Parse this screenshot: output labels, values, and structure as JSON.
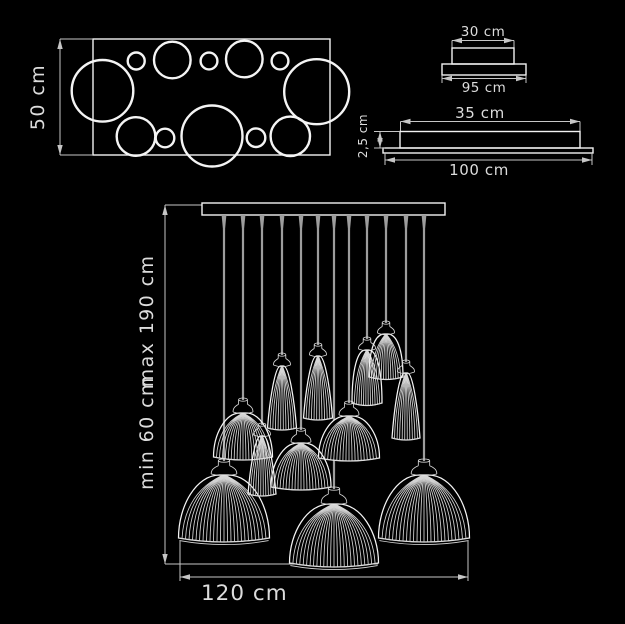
{
  "title": "pendant chandelier dimension drawing",
  "colors": {
    "background": "#000000",
    "line": "#f2f2f2",
    "dim_line": "#c6c6c6",
    "wire": "#9d9d9d",
    "text": "#dcdcdc"
  },
  "views": {
    "top_view": {
      "label": "50 cm",
      "rect": {
        "x": 93,
        "y": 39,
        "w": 237,
        "h": 116
      },
      "circles": [
        {
          "cx": 102.5,
          "cy": 90.8,
          "r": 30.8
        },
        {
          "cx": 136.2,
          "cy": 61,
          "r": 8.5
        },
        {
          "cx": 172.3,
          "cy": 60,
          "r": 18.3
        },
        {
          "cx": 209,
          "cy": 61,
          "r": 8.4
        },
        {
          "cx": 244.3,
          "cy": 59,
          "r": 18.3
        },
        {
          "cx": 280,
          "cy": 61,
          "r": 8.4
        },
        {
          "cx": 316.7,
          "cy": 91.7,
          "r": 32.5
        },
        {
          "cx": 136,
          "cy": 136.5,
          "r": 19.3
        },
        {
          "cx": 165,
          "cy": 138,
          "r": 9.3
        },
        {
          "cx": 212,
          "cy": 136,
          "r": 30.5
        },
        {
          "cx": 256,
          "cy": 137.7,
          "r": 9.3
        },
        {
          "cx": 290.3,
          "cy": 136.3,
          "r": 19.7
        }
      ],
      "dim": {
        "x": 60,
        "y1": 39,
        "y2": 155
      }
    },
    "side_view_small": {
      "top_label": "30 cm",
      "bottom_label": "95 cm",
      "box": {
        "x": 452,
        "y": 48,
        "w": 62,
        "h": 16
      },
      "base": {
        "x": 442,
        "y": 64,
        "w": 84,
        "h": 11
      },
      "top_dim": {
        "y": 40.5,
        "x1": 452,
        "x2": 514
      },
      "bottom_dim": {
        "y": 78.5,
        "x1": 442,
        "x2": 526,
        "ext_y1": 75,
        "ext_y2": 83
      }
    },
    "side_view_large": {
      "top_label": "35 cm",
      "height_label": "2,5 cm",
      "bottom_label": "100 cm",
      "box": {
        "x": 400,
        "y": 131.5,
        "w": 180,
        "h": 16.5
      },
      "base": {
        "x": 383,
        "y": 148,
        "w": 210,
        "h": 5
      },
      "top_dim": {
        "y": 121.5,
        "x1": 400.5,
        "x2": 580
      },
      "height_dim": {
        "x": 380,
        "y1": 131.5,
        "y2": 148,
        "ext_x1": 374
      },
      "bottom_dim": {
        "y": 160,
        "x1": 385,
        "x2": 592,
        "ext_y1": 153,
        "ext_y2": 165
      }
    },
    "front_view": {
      "min_label": "min 60 cm",
      "max_label": "max 190 cm",
      "width_label": "120 cm",
      "bar": {
        "x": 202,
        "y": 203,
        "w": 243,
        "h": 12
      },
      "height_dim": {
        "x": 165,
        "y1": 205,
        "y2": 564,
        "ref_x2": 378
      },
      "width_dim": {
        "y": 577,
        "x1": 180,
        "x2": 468,
        "ext_y1": 541,
        "ext_y2": 581
      },
      "wires": [
        {
          "x": 224,
          "y2": 459
        },
        {
          "x": 243,
          "y2": 398
        },
        {
          "x": 262,
          "y2": 423
        },
        {
          "x": 282,
          "y2": 353
        },
        {
          "x": 301,
          "y2": 428
        },
        {
          "x": 318,
          "y2": 343
        },
        {
          "x": 334,
          "y2": 487
        },
        {
          "x": 349,
          "y2": 401
        },
        {
          "x": 367,
          "y2": 337
        },
        {
          "x": 386,
          "y2": 321
        },
        {
          "x": 406,
          "y2": 360
        },
        {
          "x": 424,
          "y2": 459
        }
      ],
      "shades": [
        {
          "id": "G",
          "kind": "dome",
          "cx": 349,
          "w": 61,
          "neck_y": 401,
          "body_y": 416,
          "bottom_y": 458,
          "ribs": 20,
          "ns": 1.05,
          "rim": 3,
          "fill": "black"
        },
        {
          "id": "L",
          "kind": "dome",
          "cx": 334,
          "w": 89,
          "neck_y": 487,
          "body_y": 504,
          "bottom_y": 563,
          "ribs": 26,
          "ns": 1.35,
          "rim": 4,
          "fill": "black",
          "rim2": true
        },
        {
          "id": "A",
          "kind": "dome",
          "cx": 224,
          "w": 91,
          "neck_y": 459,
          "body_y": 475,
          "bottom_y": 538,
          "ribs": 26,
          "ns": 1.35,
          "rim": 4,
          "fill": "black",
          "rim2": true
        },
        {
          "id": "K",
          "kind": "dome",
          "cx": 424,
          "w": 91,
          "neck_y": 459,
          "body_y": 475,
          "bottom_y": 538,
          "ribs": 26,
          "ns": 1.35,
          "rim": 4,
          "fill": "black",
          "rim2": true
        },
        {
          "id": "B",
          "kind": "dome",
          "cx": 243,
          "w": 59,
          "neck_y": 398,
          "body_y": 413,
          "bottom_y": 457,
          "ribs": 20,
          "ns": 1.05,
          "rim": 3,
          "fill": "none"
        },
        {
          "id": "E",
          "kind": "dome",
          "cx": 301,
          "w": 60,
          "neck_y": 428,
          "body_y": 443,
          "bottom_y": 487,
          "ribs": 20,
          "ns": 1.05,
          "rim": 3,
          "fill": "none"
        },
        {
          "id": "C",
          "kind": "cone",
          "cx": 262,
          "w": 28,
          "neck_y": 423,
          "body_y": 436,
          "bottom_y": 494,
          "ribs": 11,
          "ns": 0.9,
          "rim": 2,
          "fill": "none"
        },
        {
          "id": "D",
          "kind": "cone",
          "cx": 282,
          "w": 29,
          "neck_y": 353,
          "body_y": 366,
          "bottom_y": 428,
          "ribs": 11,
          "ns": 0.9,
          "rim": 2,
          "fill": "none"
        },
        {
          "id": "F",
          "kind": "cone",
          "cx": 318,
          "w": 29,
          "neck_y": 343,
          "body_y": 356,
          "bottom_y": 418,
          "ribs": 11,
          "ns": 0.9,
          "rim": 2,
          "fill": "none"
        },
        {
          "id": "H",
          "kind": "bell",
          "cx": 367,
          "w": 30,
          "neck_y": 337,
          "body_y": 350,
          "bottom_y": 403,
          "ribs": 13,
          "ns": 0.9,
          "rim": 2.5,
          "fill": "none"
        },
        {
          "id": "I",
          "kind": "bell",
          "cx": 386,
          "w": 34,
          "neck_y": 321,
          "body_y": 334,
          "bottom_y": 377,
          "ribs": 14,
          "ns": 0.9,
          "rim": 2.5,
          "fill": "none"
        },
        {
          "id": "J",
          "kind": "cone",
          "cx": 406,
          "w": 28,
          "neck_y": 360,
          "body_y": 373,
          "bottom_y": 438,
          "ribs": 11,
          "ns": 0.9,
          "rim": 2,
          "fill": "none"
        }
      ]
    }
  }
}
